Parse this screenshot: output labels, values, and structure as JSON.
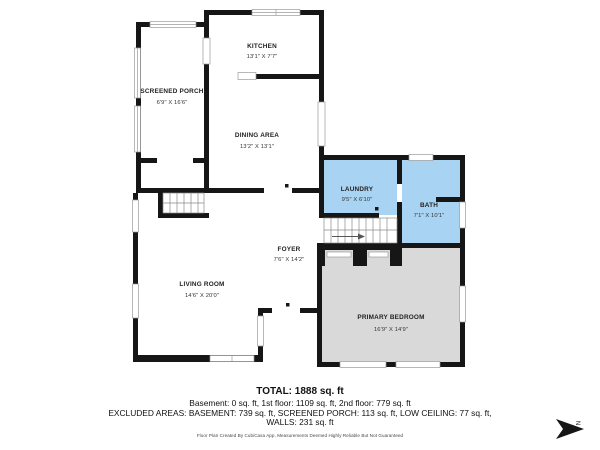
{
  "colors": {
    "wall": "#161616",
    "wet_room_fill": "#a9d3f2",
    "bedroom_fill": "#d9d9d9",
    "background": "#ffffff"
  },
  "rooms": [
    {
      "name": "KITCHEN",
      "dims": "13'1\" X 7'7\""
    },
    {
      "name": "SCREENED PORCH",
      "dims": "6'9\" X 16'6\""
    },
    {
      "name": "DINING AREA",
      "dims": "13'2\" X 13'1\""
    },
    {
      "name": "LAUNDRY",
      "dims": "9'5\" X 6'10\""
    },
    {
      "name": "BATH",
      "dims": "7'1\" X 10'1\""
    },
    {
      "name": "FOYER",
      "dims": "7'6\" X 14'2\""
    },
    {
      "name": "LIVING ROOM",
      "dims": "14'6\" X 20'0\""
    },
    {
      "name": "PRIMARY BEDROOM",
      "dims": "16'9\" X 14'9\""
    }
  ],
  "summary": {
    "total": "TOTAL: 1888 sq. ft",
    "floors": "Basement: 0 sq. ft, 1st floor: 1109 sq. ft, 2nd floor: 779 sq. ft",
    "excluded": "EXCLUDED AREAS: BASEMENT: 739 sq. ft, SCREENED PORCH: 113 sq. ft, LOW CEILING: 77 sq. ft,",
    "walls": "WALLS: 231 sq. ft"
  },
  "credit": "Floor Plan Created By CubiCasa App, Measurements Deemed Highly Reliable But Not Guaranteed",
  "compass": {
    "label": "N"
  }
}
